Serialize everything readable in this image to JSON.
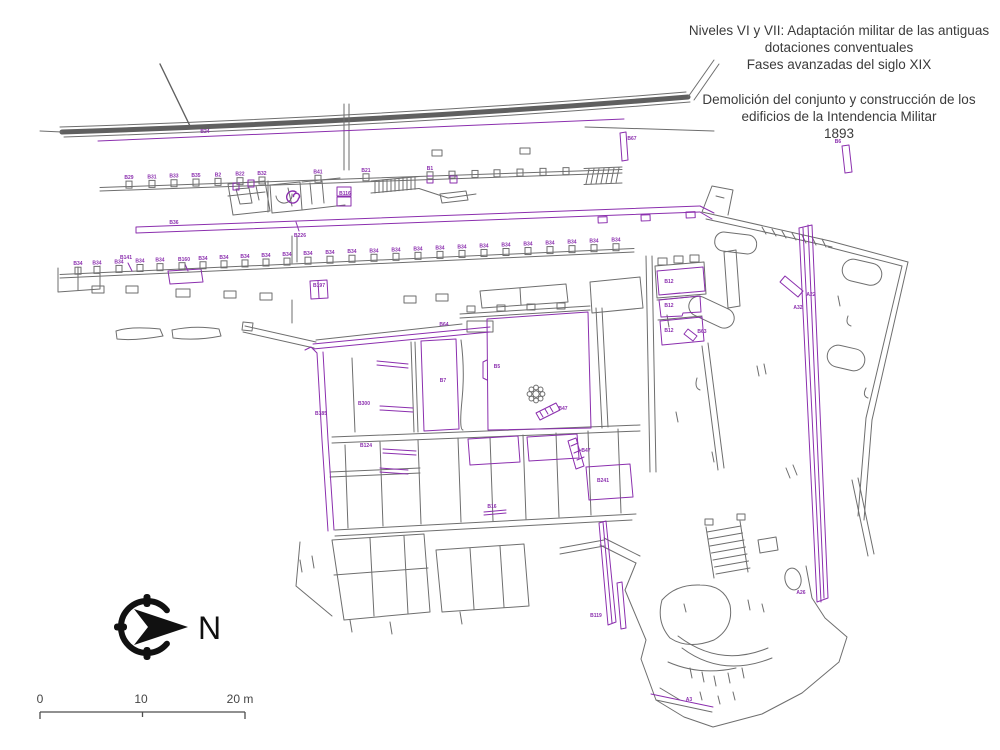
{
  "title": {
    "line1": "Niveles VI y VII: Adaptación militar de las antiguas",
    "line2": "dotaciones conventuales",
    "line3": "Fases avanzadas del siglo XIX",
    "line4": "Demolición del conjunto y construcción de los",
    "line5": "edificios de la Intendencia Militar",
    "line6": "1893"
  },
  "compass": {
    "north_label": "N"
  },
  "scale_bar": {
    "tick0": "0",
    "tick1": "10",
    "tick2": "20 m"
  },
  "colors": {
    "line_gray": "#6e6e6e",
    "wall_dark": "#5f5f5f",
    "annotation_purple": "#8b2fae",
    "background": "#ffffff",
    "title_text": "#3b3b3b"
  },
  "plan": {
    "row1_piers": [
      {
        "x": 129,
        "label": "B29"
      },
      {
        "x": 152,
        "label": "B31"
      },
      {
        "x": 174,
        "label": "B33"
      },
      {
        "x": 196,
        "label": "B35"
      },
      {
        "x": 218,
        "label": "B2"
      },
      {
        "x": 240,
        "label": "B22"
      },
      {
        "x": 262,
        "label": "B32"
      },
      {
        "x": 318,
        "label": "B41"
      },
      {
        "x": 366,
        "label": "B21"
      },
      {
        "x": 430,
        "label": "B1"
      },
      {
        "x": 452,
        "label": ""
      },
      {
        "x": 475,
        "label": ""
      },
      {
        "x": 497,
        "label": ""
      },
      {
        "x": 520,
        "label": ""
      },
      {
        "x": 543,
        "label": ""
      },
      {
        "x": 566,
        "label": ""
      }
    ],
    "row2_repeat_label": "B34",
    "row2_xs": [
      78,
      97,
      119,
      140,
      160,
      182,
      203,
      224,
      245,
      266,
      287,
      308,
      330,
      352,
      374,
      396,
      418,
      440,
      462,
      484,
      506,
      528,
      550,
      572,
      594,
      616
    ],
    "row2_unlabeled_xs": [
      182
    ],
    "labels": [
      {
        "t": "B24",
        "x": 205,
        "y": 133
      },
      {
        "t": "B67",
        "x": 632,
        "y": 140
      },
      {
        "t": "B6",
        "x": 838,
        "y": 143
      },
      {
        "t": "B116",
        "x": 345,
        "y": 195
      },
      {
        "t": "B36",
        "x": 174,
        "y": 224
      },
      {
        "t": "B226",
        "x": 300,
        "y": 237
      },
      {
        "t": "B141",
        "x": 126,
        "y": 259
      },
      {
        "t": "B160",
        "x": 184,
        "y": 261
      },
      {
        "t": "B197",
        "x": 319,
        "y": 287
      },
      {
        "t": "B64",
        "x": 444,
        "y": 326
      },
      {
        "t": "B5",
        "x": 497,
        "y": 368
      },
      {
        "t": "B7",
        "x": 443,
        "y": 382
      },
      {
        "t": "B185",
        "x": 321,
        "y": 415
      },
      {
        "t": "B300",
        "x": 364,
        "y": 405
      },
      {
        "t": "B124",
        "x": 366,
        "y": 447
      },
      {
        "t": "B16",
        "x": 492,
        "y": 508
      },
      {
        "t": "B47",
        "x": 563,
        "y": 410
      },
      {
        "t": "B47",
        "x": 586,
        "y": 452
      },
      {
        "t": "B241",
        "x": 603,
        "y": 482
      },
      {
        "t": "B119",
        "x": 596,
        "y": 617
      },
      {
        "t": "B12",
        "x": 669,
        "y": 283
      },
      {
        "t": "B12",
        "x": 669,
        "y": 307
      },
      {
        "t": "B12",
        "x": 669,
        "y": 332
      },
      {
        "t": "B63",
        "x": 702,
        "y": 333
      },
      {
        "t": "A22",
        "x": 811,
        "y": 296
      },
      {
        "t": "A32",
        "x": 798,
        "y": 309
      },
      {
        "t": "A26",
        "x": 801,
        "y": 594
      },
      {
        "t": "A3",
        "x": 689,
        "y": 701
      }
    ]
  }
}
